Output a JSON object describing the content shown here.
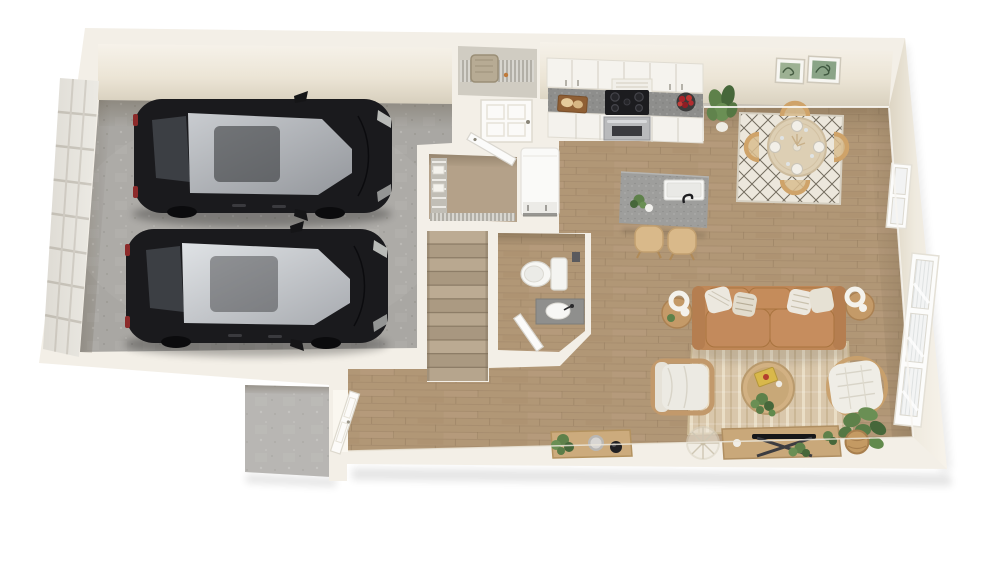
{
  "scene": {
    "type": "3d-floor-plan-rendering",
    "view": "top-down dollhouse cutaway of a single-storey townhome level",
    "background": "#ffffff"
  },
  "colors": {
    "wall": "#f3efe7",
    "wall_face_top": "#f6f2ea",
    "wall_face_bottom": "#d7cfbd",
    "garage_floor": "#a9a7a3",
    "wood_floor": "#b19776",
    "wood_line": "#a0876a",
    "stair_light": "#bcab93",
    "stair_dark": "#ac9b83",
    "counter": "#8e8e8c",
    "island": "#9e9e9c",
    "cabinet": "#f5f3ee",
    "sofa": "#bf8757",
    "sofa_cushion": "#c8905f",
    "pillow": "#ece8df",
    "rug_living": "#d9c7ab",
    "rug_living_stripe": "#eadec6",
    "rug_dining": "#ece7dc",
    "rug_dining_line": "#4a4334",
    "car_body": "#1a1a1d",
    "car_glass_bright": "#d8dbde",
    "car_glass": "#c9ccd0",
    "fridge": "#fafaf8",
    "steel": "#b9babc",
    "cooktop": "#1c1c1f",
    "furniture_wood": "#c9a87a",
    "chair_wood": "#cfa369",
    "plant": "#5e814a",
    "plant_dark": "#46673a",
    "stoop_concrete": "#b4b2ae",
    "window_frame": "#fcfcfb"
  },
  "rooms": [
    {
      "id": "garage",
      "label": "2-car garage",
      "floor": "concrete",
      "items": [
        "sedan-car",
        "sedan-car",
        "sectional-garage-door"
      ]
    },
    {
      "id": "utility-closet",
      "label": "utility closet",
      "floor": "concrete",
      "items": [
        "water-heater",
        "wire-shelf"
      ]
    },
    {
      "id": "storage-closet",
      "label": "storage closet",
      "floor": "wood",
      "items": [
        "wire-shelving",
        "open-door"
      ]
    },
    {
      "id": "staircase",
      "label": "staircase",
      "floor": "wood",
      "items": [
        "stair-treads"
      ]
    },
    {
      "id": "powder-room",
      "label": "powder room",
      "floor": "wood",
      "items": [
        "toilet",
        "vanity-sink",
        "open-door"
      ]
    },
    {
      "id": "entry",
      "label": "entry hall",
      "floor": "wood",
      "items": [
        "front-door",
        "concrete-stoop",
        "console-table",
        "potted-plant",
        "gray-bowl",
        "black-bowl"
      ]
    },
    {
      "id": "kitchen",
      "label": "kitchen",
      "floor": "wood",
      "items": [
        "upper-cabinets",
        "range-hood",
        "cooktop-range",
        "oven",
        "speckled-countertop",
        "lower-cabinets",
        "cutting-board-with-bread",
        "fruit-bowl",
        "refrigerator",
        "kitchen-island",
        "island-sink",
        "bar-stool",
        "bar-stool",
        "potted-plant"
      ]
    },
    {
      "id": "dining",
      "label": "dining nook",
      "floor": "wood",
      "items": [
        "round-dining-table",
        "dining-chair",
        "dining-chair",
        "dining-chair",
        "dining-chair",
        "place-settings",
        "diamond-pattern-rug",
        "botanical-wall-art",
        "botanical-wall-art",
        "window"
      ]
    },
    {
      "id": "living",
      "label": "living room",
      "floor": "wood",
      "items": [
        "leather-sofa",
        "throw-pillows",
        "end-table",
        "end-table",
        "sculptural-lamp",
        "sculptural-lamp",
        "white-armchair",
        "rattan-armchair",
        "round-coffee-table",
        "striped-area-rug",
        "media-console",
        "tv-on-stand",
        "wire-side-table",
        "potted-plants",
        "basket-plant",
        "triple-window"
      ]
    }
  ]
}
